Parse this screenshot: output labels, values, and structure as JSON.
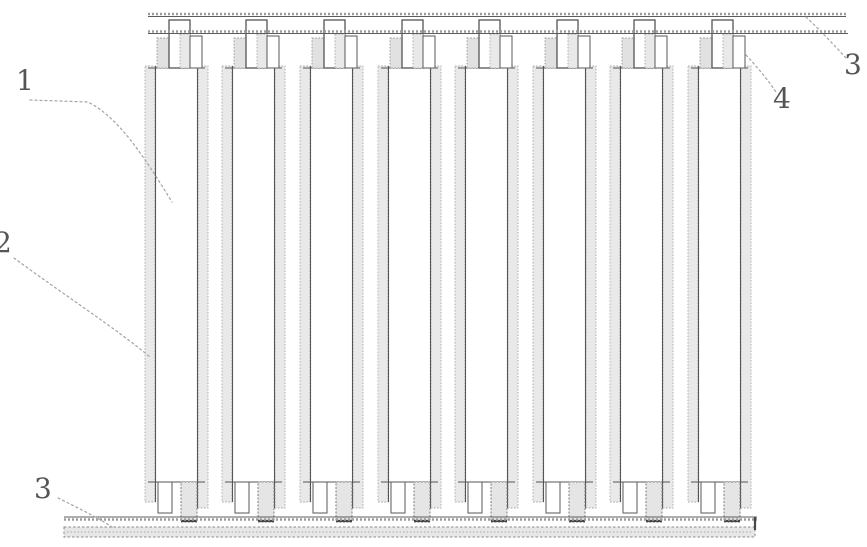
{
  "figure": {
    "kind": "patent-line-drawing",
    "description": "Stack of eight vertical plates hung by hooks from a top rail onto a bottom bar",
    "panel_count": 8,
    "labels": [
      {
        "name": "label-1",
        "text": "1"
      },
      {
        "name": "label-2",
        "text": "2"
      },
      {
        "name": "label-3-bottom",
        "text": "3"
      },
      {
        "name": "label-3-top-right",
        "text": "3"
      },
      {
        "name": "label-4",
        "text": "4"
      }
    ],
    "colors": {
      "background": "#ffffff",
      "line": "#555555",
      "stipple_fill": "#e9e9e9",
      "label_text": "#555555",
      "leader": "#a3a3a3"
    }
  }
}
